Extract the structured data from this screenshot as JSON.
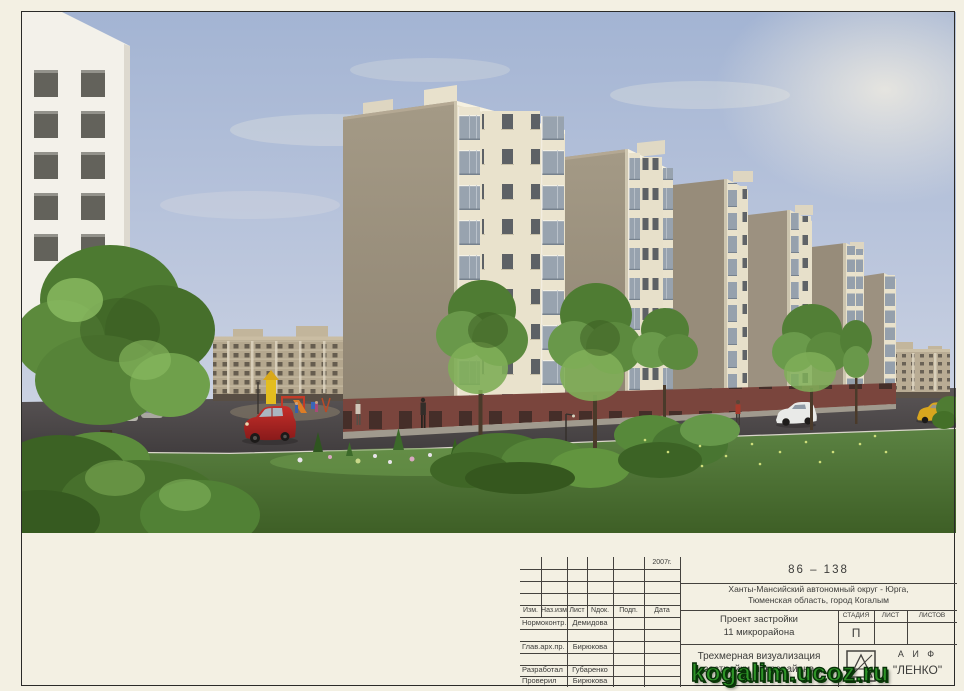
{
  "title_block": {
    "year": "2007г.",
    "doc_number": "86 – 138",
    "location_line1": "Ханты-Мансийский автономный округ - Юрга,",
    "location_line2": "Тюменская область,  город Когалым",
    "project_line1": "Проект застройки",
    "project_line2": "11 микрорайона",
    "sheet_title_line1": "Трехмерная визуализация",
    "sheet_title_line2": "застройки микрорайона",
    "col_izm": "Изм.",
    "col_naz": "Наз.изм",
    "col_list": "Лист",
    "col_ndok": "Nдок.",
    "col_podp": "Подп.",
    "col_data": "Дата",
    "stage_header": "СТАДИЯ",
    "list_header": "ЛИСТ",
    "listov_header": "ЛИСТОВ",
    "stage_value": "П",
    "normcontrol_role": "Нормоконтр.",
    "normcontrol_name": "Демидова",
    "chief_arch_role": "Глав.арх.пр.",
    "chief_arch_name": "Бирюкова",
    "developed_role": "Разработал",
    "developed_name": "Губаренко",
    "checked_role": "Проверил",
    "checked_name": "Бирюкова",
    "company_line1": "А И Ф",
    "company_line2": "\"ЛЕНКО\""
  },
  "watermark": {
    "text": "kogalim.ucoz.ru",
    "color": "#2e9427"
  },
  "scene": {
    "description": "3D visualization of an 8-storey residential complex (microdistrict 11): cream apartment blocks with taupe side walls and brick bases, foreground white tower, lawn with flower bed, bushes, trees, playground, road with red minivan, white and yellow cars, background apartment buildings",
    "colors": {
      "sky": "#b3c0da",
      "facade_cream": "#e9e2cc",
      "facade_taupe": "#998e7c",
      "brick_base": "#7a453d",
      "lawn": "#4e7536",
      "asphalt": "#4a4647",
      "red_car": "#b02423",
      "page": "#f3f0e3"
    }
  }
}
